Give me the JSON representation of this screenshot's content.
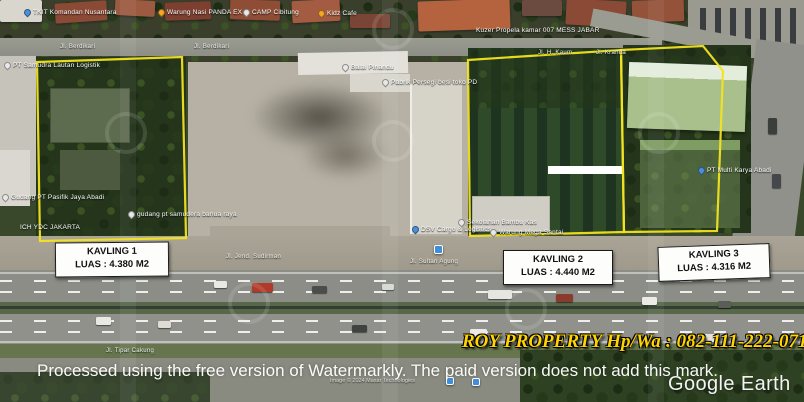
{
  "overlay": {
    "contact": "ROY PROPERTY Hp/Wa : 082-111-222-071",
    "watermark_notice": "Processed using the free version of Watermarkly. The paid version does not add this mark.",
    "logo": "Google Earth",
    "attribution": "Image © 2024 Maxar Technologies"
  },
  "kavling": [
    {
      "title": "KAVLING 1",
      "area": "LUAS : 4.380 M2"
    },
    {
      "title": "KAVLING 2",
      "area": "LUAS : 4.440 M2"
    },
    {
      "title": "KAVLING 3",
      "area": "LUAS : 4.316 M2"
    }
  ],
  "poi": [
    {
      "label": "TKIT Komandan Nusantara"
    },
    {
      "label": "Warung Nasi PANDA EX"
    },
    {
      "label": "CAMP Cibitung"
    },
    {
      "label": "Kidz Cafe"
    },
    {
      "label": "Kuzer Propela kamar 007 MESS JABAR"
    },
    {
      "label": "PT Samudra Lautan Logistik"
    },
    {
      "label": "Balai Pinandu"
    },
    {
      "label": "Pabrik Persegi besi toko PD"
    },
    {
      "label": "Gudang PT Pasifik Jaya Abadi"
    },
    {
      "label": "gudang pt samudera banua raya"
    },
    {
      "label": "ICH YDC JAKARTA"
    },
    {
      "label": "DSV Cargo & Logistics"
    },
    {
      "label": "Sekolahan Bambu Kas"
    },
    {
      "label": "Warung Mega Santai"
    },
    {
      "label": "PT Multi Karya Abadi"
    }
  ],
  "streets": [
    {
      "label": "Jl. Berdikari"
    },
    {
      "label": "Jl. Berdikari"
    },
    {
      "label": "Jl. H. Kaum"
    },
    {
      "label": "Jl. Kranda"
    },
    {
      "label": "Jl. Jend. Sudirman"
    },
    {
      "label": "Jl. Sultan Agung"
    },
    {
      "label": "Jl. Tipar Cakung"
    }
  ],
  "colors": {
    "plot_outline": "#f2e41f",
    "contact_text": "#ffd400",
    "label_box_bg": "#fdfdfb",
    "label_box_border": "#1a1a1a"
  }
}
